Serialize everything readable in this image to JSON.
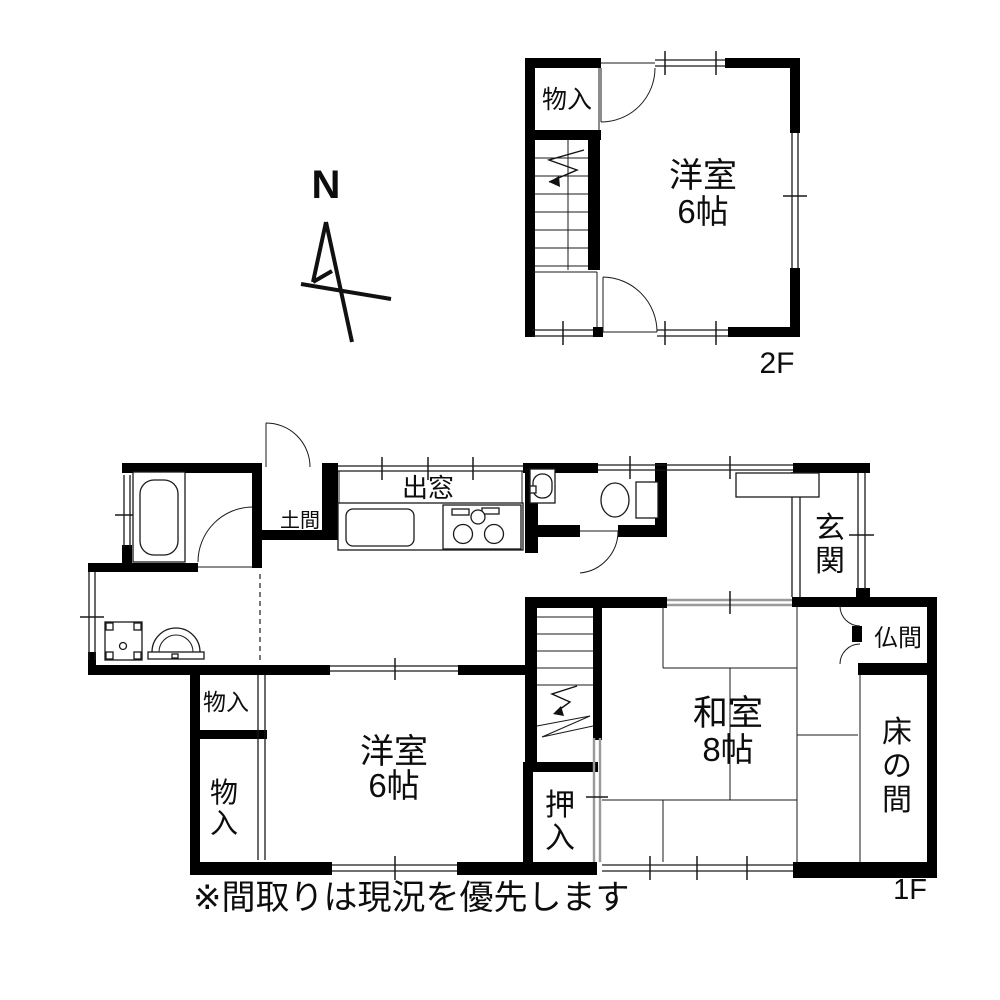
{
  "compass": {
    "label": "N"
  },
  "floor2": {
    "label": "2F",
    "storage": "物入",
    "room_name": "洋室",
    "room_size": "6帖"
  },
  "floor1": {
    "label": "1F",
    "doma": "土間",
    "bay_window": "出窓",
    "entrance": "玄関",
    "butsuma": "仏間",
    "tokonoma": "床の間",
    "washitsu_name": "和室",
    "washitsu_size": "8帖",
    "youshitsu_name": "洋室",
    "youshitsu_size": "6帖",
    "closet_upper": "物入",
    "closet_lower": "物入",
    "oshiire": "押入"
  },
  "note": "※間取りは現況を優先します",
  "colors": {
    "wall": "#000000",
    "line": "#1a1a1a",
    "slider": "#9a9a9a",
    "bg": "#ffffff"
  }
}
